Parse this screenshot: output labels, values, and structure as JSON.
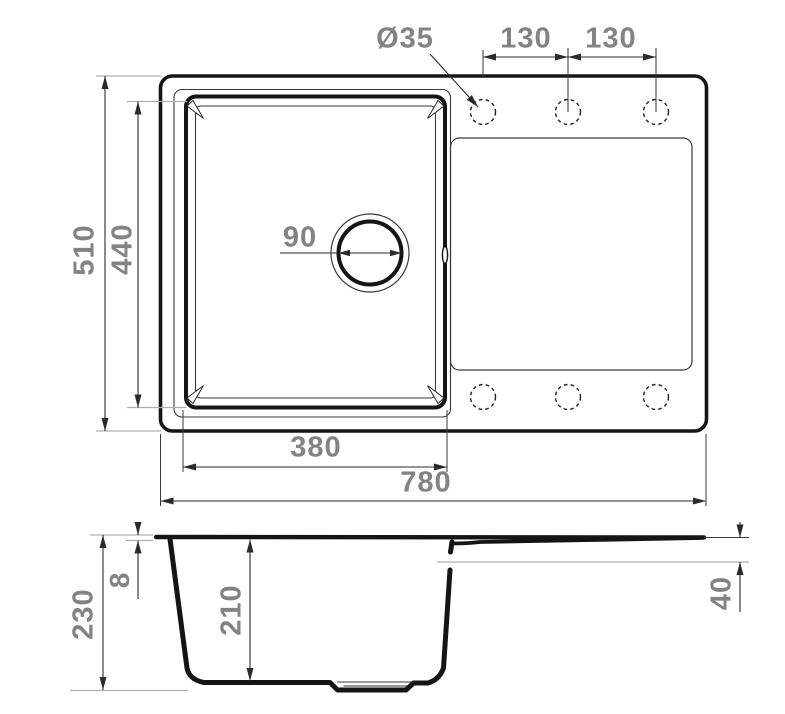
{
  "colors": {
    "outline": "#151515",
    "dim_line": "#3a3a3a",
    "dim_text": "#838383",
    "light_extension_line": "#b0b0b0",
    "background": "#ffffff"
  },
  "top_view": {
    "dimensions": {
      "faucet_hole_diameter": "Ø35",
      "faucet_spacing_left": "130",
      "faucet_spacing_right": "130",
      "overall_depth": "510",
      "bowl_depth": "440",
      "drain_diameter": "90",
      "bowl_width": "380",
      "overall_width": "780"
    }
  },
  "side_view": {
    "dimensions": {
      "overall_height": "230",
      "rim_thickness": "8",
      "bowl_inner_depth": "210",
      "drainboard_edge_height": "40"
    }
  }
}
